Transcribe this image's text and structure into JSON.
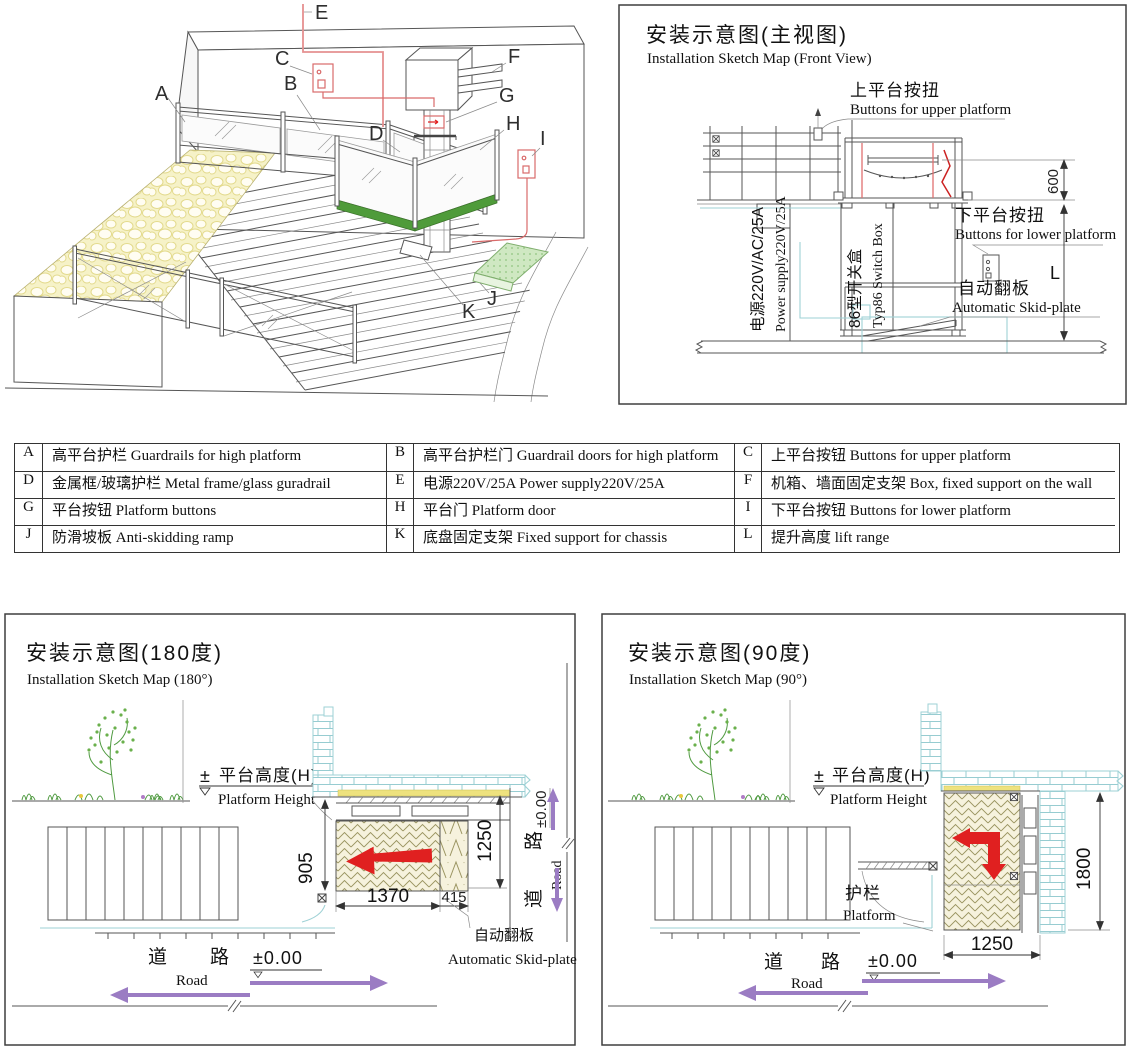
{
  "iso": {
    "labels": {
      "A": "A",
      "B": "B",
      "C": "C",
      "D": "D",
      "E": "E",
      "F": "F",
      "G": "G",
      "H": "H",
      "I": "I",
      "J": "J",
      "K": "K"
    }
  },
  "front_view": {
    "title_cn": "安装示意图(主视图)",
    "title_en": "Installation Sketch Map (Front View)",
    "upper_btn_cn": "上平台按扭",
    "upper_btn_en": "Buttons for upper platform",
    "lower_btn_cn": "下平台按扭",
    "lower_btn_en": "Buttons for lower platform",
    "flap_cn": "自动翻板",
    "flap_en": "Automatic Skid-plate",
    "power_cn": "电源220V/AC/25A",
    "power_en": "Power supply220V/25A",
    "switch_cn": "86型开关盒",
    "switch_en": "Typ86 Switch Box",
    "dim_600": "600",
    "dim_l": "L"
  },
  "legend": {
    "rows": [
      [
        "A",
        "高平台护栏 Guardrails for high platform",
        "B",
        "高平台护栏门 Guardrail doors for high platform",
        "C",
        "上平台按钮 Buttons for upper platform"
      ],
      [
        "D",
        "金属框/玻璃护栏 Metal frame/glass guradrail",
        "E",
        "电源220V/25A Power supply220V/25A",
        "F",
        "机箱、墙面固定支架 Box, fixed support on the wall"
      ],
      [
        "G",
        "平台按钮 Platform buttons",
        "H",
        "平台门 Platform door",
        "I",
        "下平台按钮 Buttons for lower platform"
      ],
      [
        "J",
        "防滑坡板 Anti-skidding ramp",
        "K",
        "底盘固定支架 Fixed support for chassis",
        "L",
        "提升高度  lift range"
      ]
    ]
  },
  "map180": {
    "title_cn": "安装示意图(180度)",
    "title_en": "Installation Sketch Map (180°)",
    "pm": "±",
    "height_cn": "平台高度(H)",
    "height_en": "Platform Height",
    "d905": "905",
    "d1250": "1250",
    "d1370": "1370",
    "d415": "415",
    "flap_cn": "自动翻板",
    "flap_en": "Automatic Skid-plate",
    "road_cn1": "道",
    "road_cn2": "路",
    "road_en": "Road",
    "level": "±0.00"
  },
  "map90": {
    "title_cn": "安装示意图(90度)",
    "title_en": "Installation Sketch Map (90°)",
    "pm": "±",
    "height_cn": "平台高度(H)",
    "height_en": "Platform Height",
    "rail_cn": "护栏",
    "rail_en": "Platform",
    "d1800": "1800",
    "d1250": "1250",
    "road_cn1": "道",
    "road_cn2": "路",
    "road_en": "Road",
    "level": "±0.00"
  },
  "colors": {
    "line": "#4d4d4d",
    "red_arrow": "#e02020",
    "cable_red": "#e59090",
    "green_platform": "#4f9b3a",
    "skid_green": "#cfe8c2",
    "ramp_yellow": "#f6f2c8",
    "brick_cyan": "#9ed1d5",
    "road_purple": "#9b7cc3",
    "hatch_olive": "#9a9460",
    "floor_yellow": "#eee27e"
  }
}
